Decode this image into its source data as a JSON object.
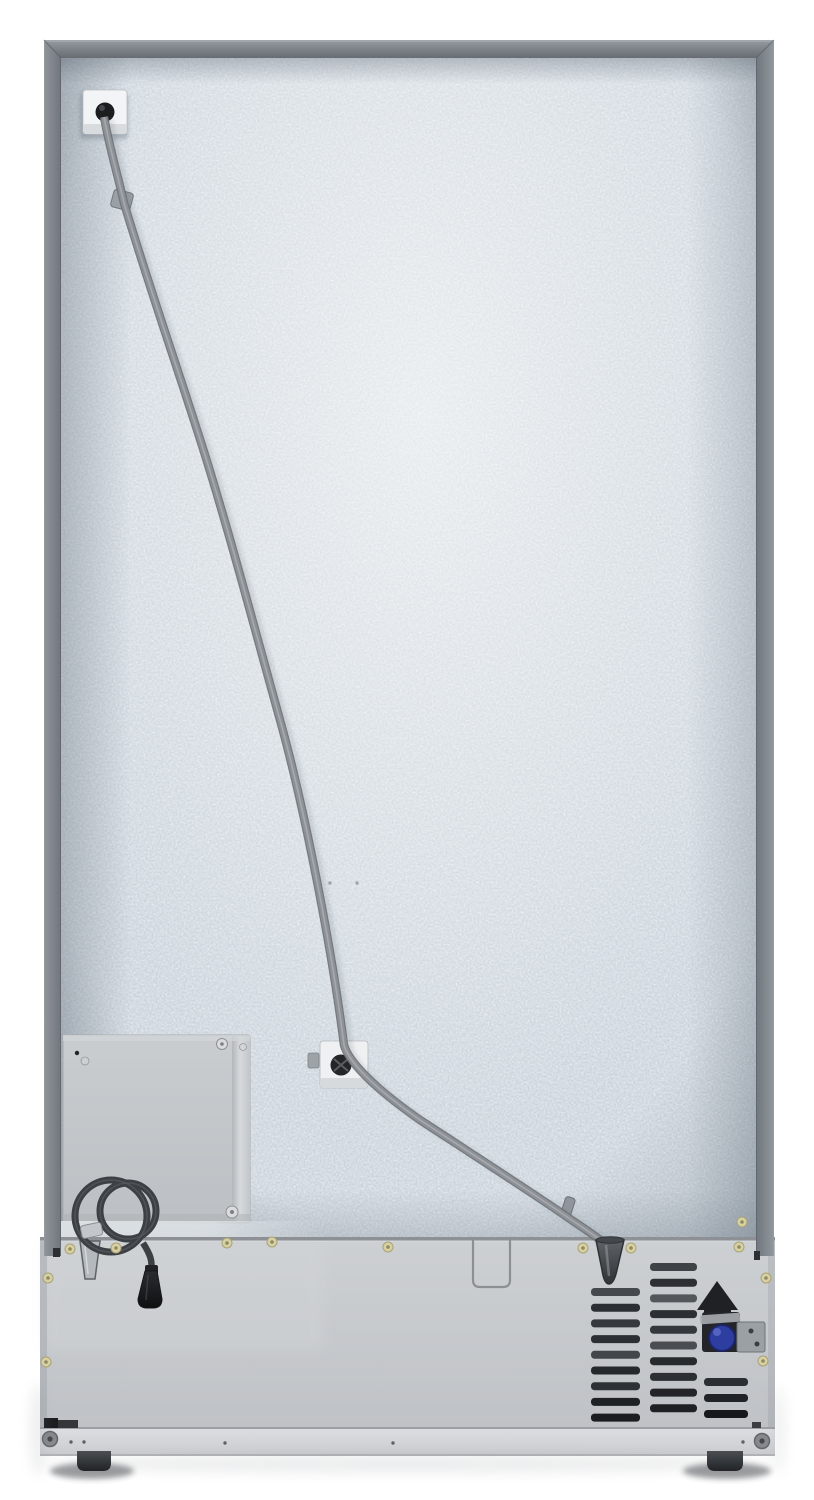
{
  "meta": {
    "title": "Refrigerator rear view product photo",
    "view": "rear"
  },
  "appliance": {
    "parts": {
      "back_panel": "galvanized textured back panel",
      "frame_top": "top cabinet frame rail",
      "frame_left": "left cabinet frame rail",
      "frame_right": "right cabinet frame rail",
      "water_line": "water supply tube",
      "water_line_top_bracket": "water line top bracket",
      "water_line_mid_clamp": "water line mid clamp",
      "tube_clip_upper": "tube retaining clip",
      "tube_clip_lower": "tube retaining clip",
      "drain_funnel": "drain tube funnel",
      "access_panel": "lower access cover",
      "access_cutout": "drain access cutout",
      "panel_flange": "back panel bottom flange",
      "power_cord_coil": "coiled power cord",
      "power_plug": "power plug",
      "cord_strap": "cord retaining strap",
      "cord_bracket": "cord storage bracket",
      "vent_grille": "compressor vent grille",
      "water_valve": "water inlet valve",
      "valve_solenoid": "valve solenoid coil",
      "valve_bracket": "valve mounting bracket",
      "machine_compartment": "machine compartment panel",
      "kick_plate": "base kick plate",
      "corner_bracket": "base corner bracket",
      "foot_left": "left rear leveling foot",
      "foot_right": "right rear leveling foot",
      "bolt_left": "base bolt",
      "bolt_right": "base bolt",
      "screws": "gold mounting screws",
      "pin_holes": "alignment pin holes"
    }
  },
  "colors": {
    "background": "#ffffff",
    "panel_base": "#ccd4db",
    "frame": "#7d8389",
    "access_panel": "#c4c8cc",
    "compartment": "#c8cbcf",
    "kick_plate": "#d8dadd",
    "tube": "#8d9196",
    "cord": "#3c4044",
    "plug": "#141618",
    "vent_slat": "#2c2f33",
    "valve_blue": "#2e3da0",
    "screw_gold": "#d7d0a2",
    "foot": "#2f3236"
  }
}
